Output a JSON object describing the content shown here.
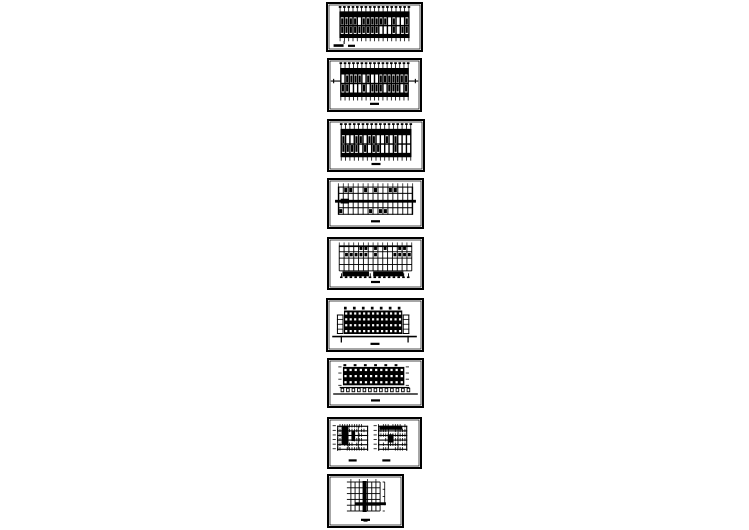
{
  "page": {
    "description": "Vertical stack of nine black-and-white architectural CAD drawing sheet thumbnails on a white background",
    "background_color": "#ffffff",
    "ink_color": "#000000"
  },
  "sheets": [
    {
      "name": "sheet-1",
      "kind": "plan",
      "x": 326,
      "y": 2,
      "w": 97,
      "h": 50,
      "seed": 11,
      "caption": "left-bars",
      "side_ticks": false
    },
    {
      "name": "sheet-2",
      "kind": "plan",
      "x": 327,
      "y": 58,
      "w": 95,
      "h": 54,
      "seed": 22,
      "caption": "center-dash",
      "side_ticks": true
    },
    {
      "name": "sheet-3",
      "kind": "plan",
      "x": 327,
      "y": 119,
      "w": 98,
      "h": 53,
      "seed": 33,
      "caption": "center-dash",
      "side_ticks": false
    },
    {
      "name": "sheet-4",
      "kind": "plan-band",
      "x": 327,
      "y": 178,
      "w": 97,
      "h": 51,
      "seed": 44,
      "caption": "center-dash",
      "side_ticks": false
    },
    {
      "name": "sheet-5",
      "kind": "plan-bars",
      "x": 327,
      "y": 237,
      "w": 97,
      "h": 53,
      "seed": 55,
      "caption": "center-dash",
      "side_ticks": false
    },
    {
      "name": "sheet-6",
      "kind": "elevation",
      "x": 326,
      "y": 298,
      "w": 98,
      "h": 54,
      "seed": 66,
      "caption": "center-dash",
      "side_ticks": false
    },
    {
      "name": "sheet-7",
      "kind": "elevation-arcade",
      "x": 327,
      "y": 358,
      "w": 97,
      "h": 50,
      "seed": 77,
      "caption": "center-dash",
      "side_ticks": false
    },
    {
      "name": "sheet-8",
      "kind": "sections",
      "x": 327,
      "y": 417,
      "w": 95,
      "h": 52,
      "seed": 88,
      "caption": "dual-dash",
      "side_ticks": false
    },
    {
      "name": "sheet-9",
      "kind": "detail",
      "x": 327,
      "y": 474,
      "w": 77,
      "h": 54,
      "seed": 99,
      "caption": "center-dash",
      "side_ticks": false
    }
  ]
}
